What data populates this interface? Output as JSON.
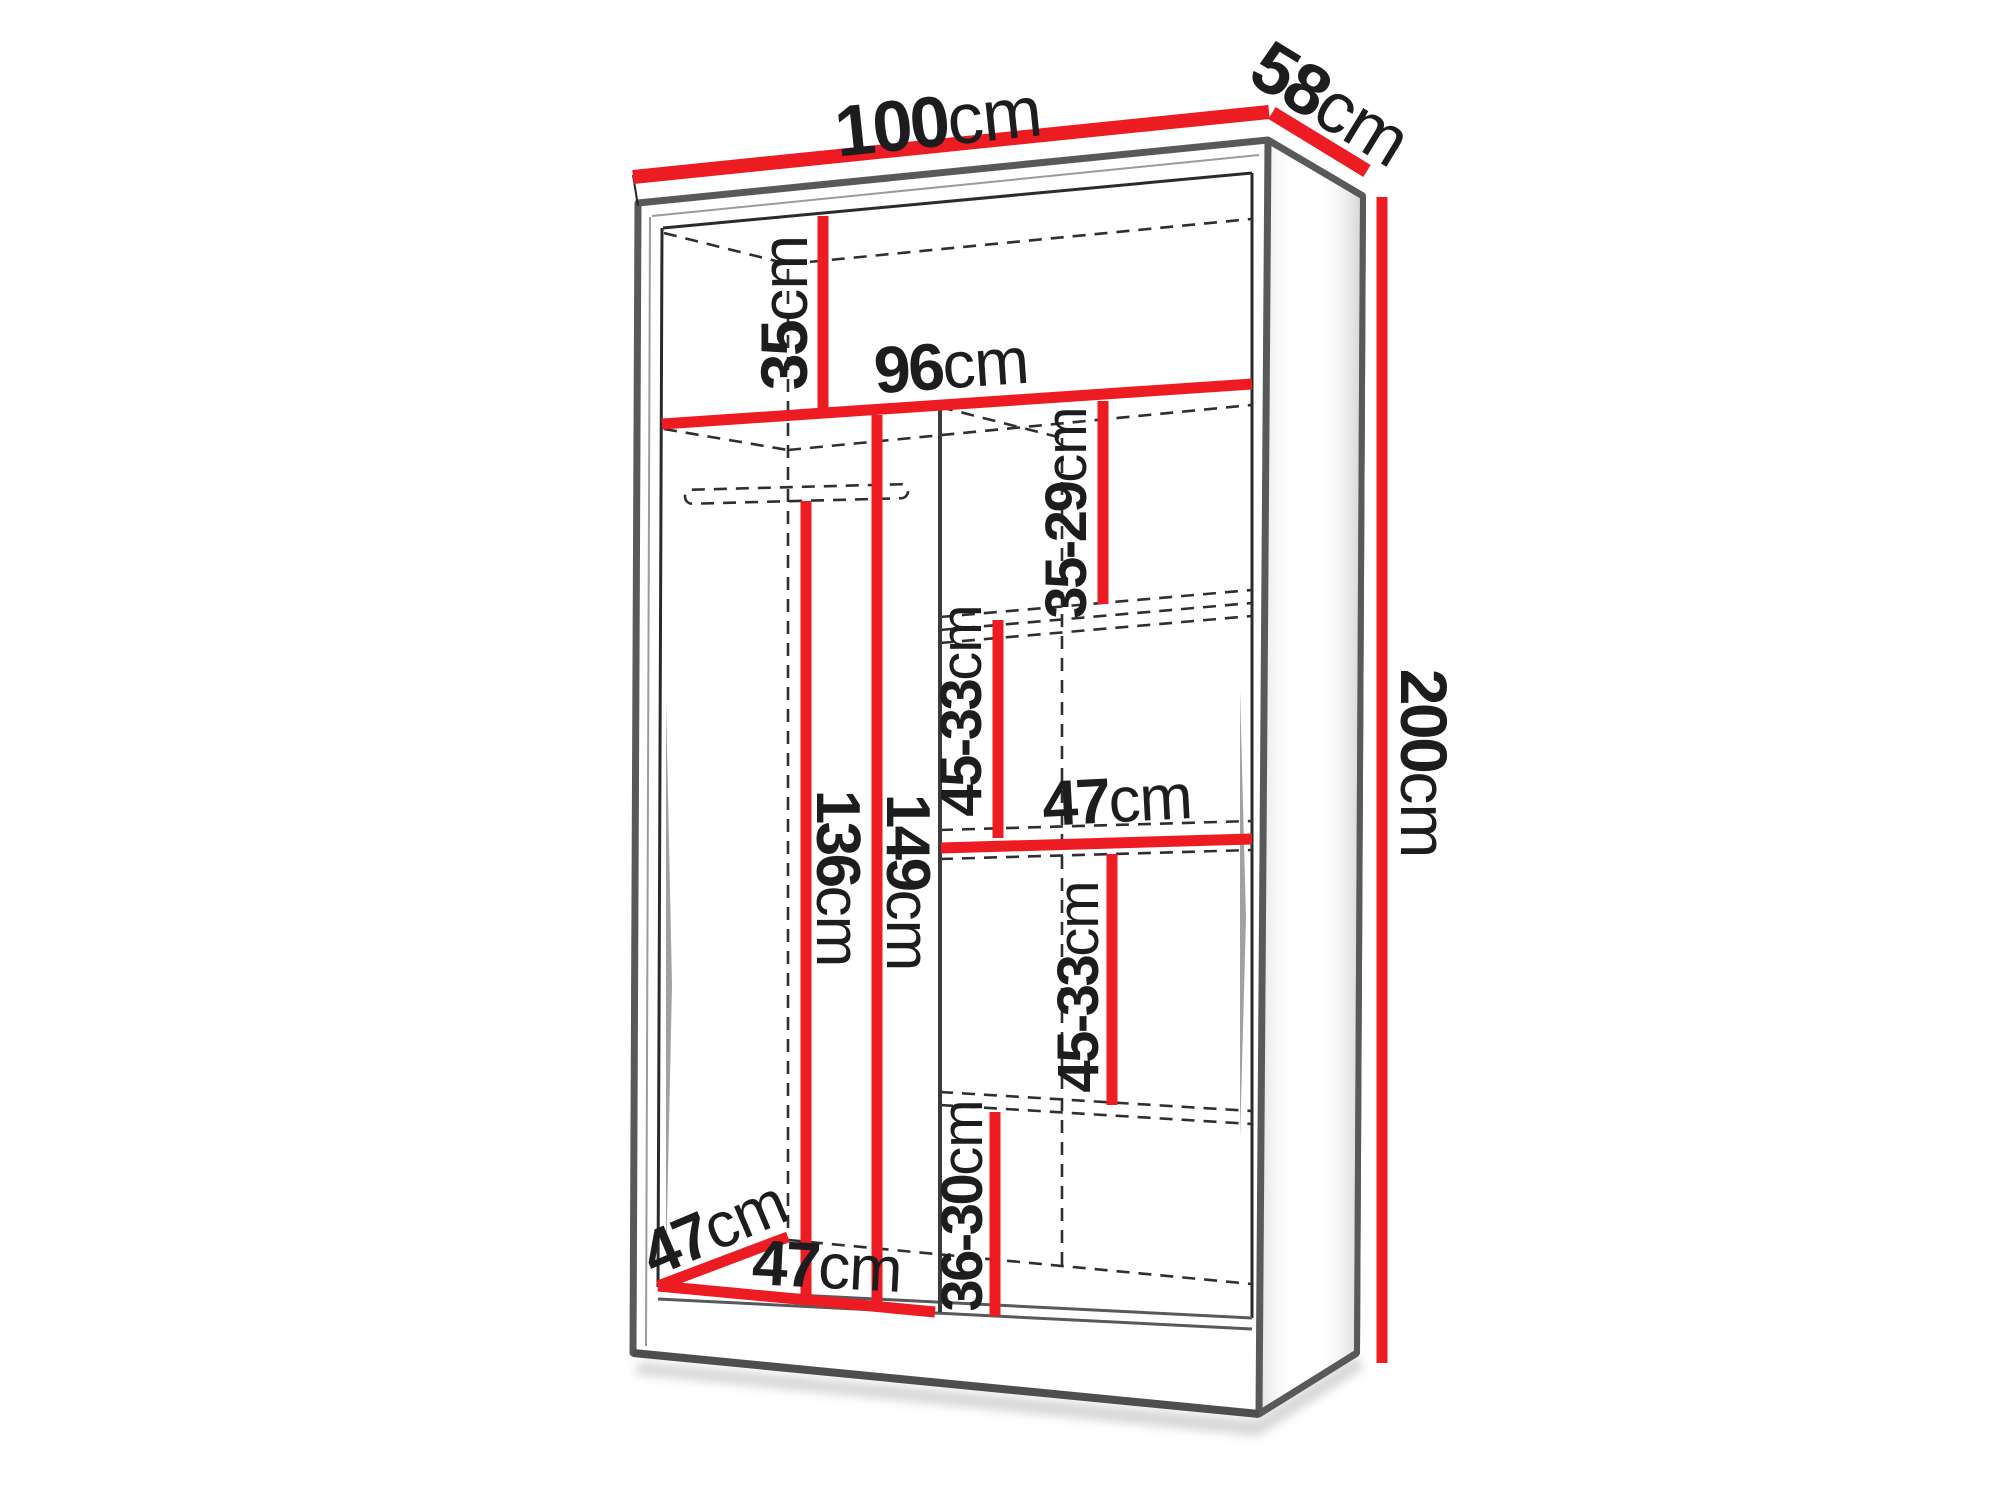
{
  "diagram": {
    "type": "wardrobe-dimension-drawing",
    "colors": {
      "dimension_red": "#ed1b22",
      "outline_gray": "#58595b",
      "hidden_edge": "#2f2f31",
      "label_text": "#1d1d1f",
      "background": "#ffffff"
    },
    "labels": {
      "width": {
        "value": "100",
        "unit": "cm"
      },
      "depth": {
        "value": "58",
        "unit": "cm"
      },
      "height": {
        "value": "200",
        "unit": "cm"
      },
      "top_compartment": {
        "value": "35",
        "unit": "cm"
      },
      "interior_width": {
        "value": "96",
        "unit": "cm"
      },
      "right_gap_top": {
        "value": "35-29",
        "unit": "cm"
      },
      "right_gap_upper": {
        "value": "45-33",
        "unit": "cm"
      },
      "right_shelf_width": {
        "value": "47",
        "unit": "cm"
      },
      "right_gap_lower": {
        "value": "45-33",
        "unit": "cm"
      },
      "right_gap_bottom": {
        "value": "36-30",
        "unit": "cm"
      },
      "rail_height": {
        "value": "136",
        "unit": "cm"
      },
      "hanging_height": {
        "value": "149",
        "unit": "cm"
      },
      "interior_depth": {
        "value": "47",
        "unit": "cm"
      },
      "left_section_width": {
        "value": "47",
        "unit": "cm"
      }
    }
  }
}
